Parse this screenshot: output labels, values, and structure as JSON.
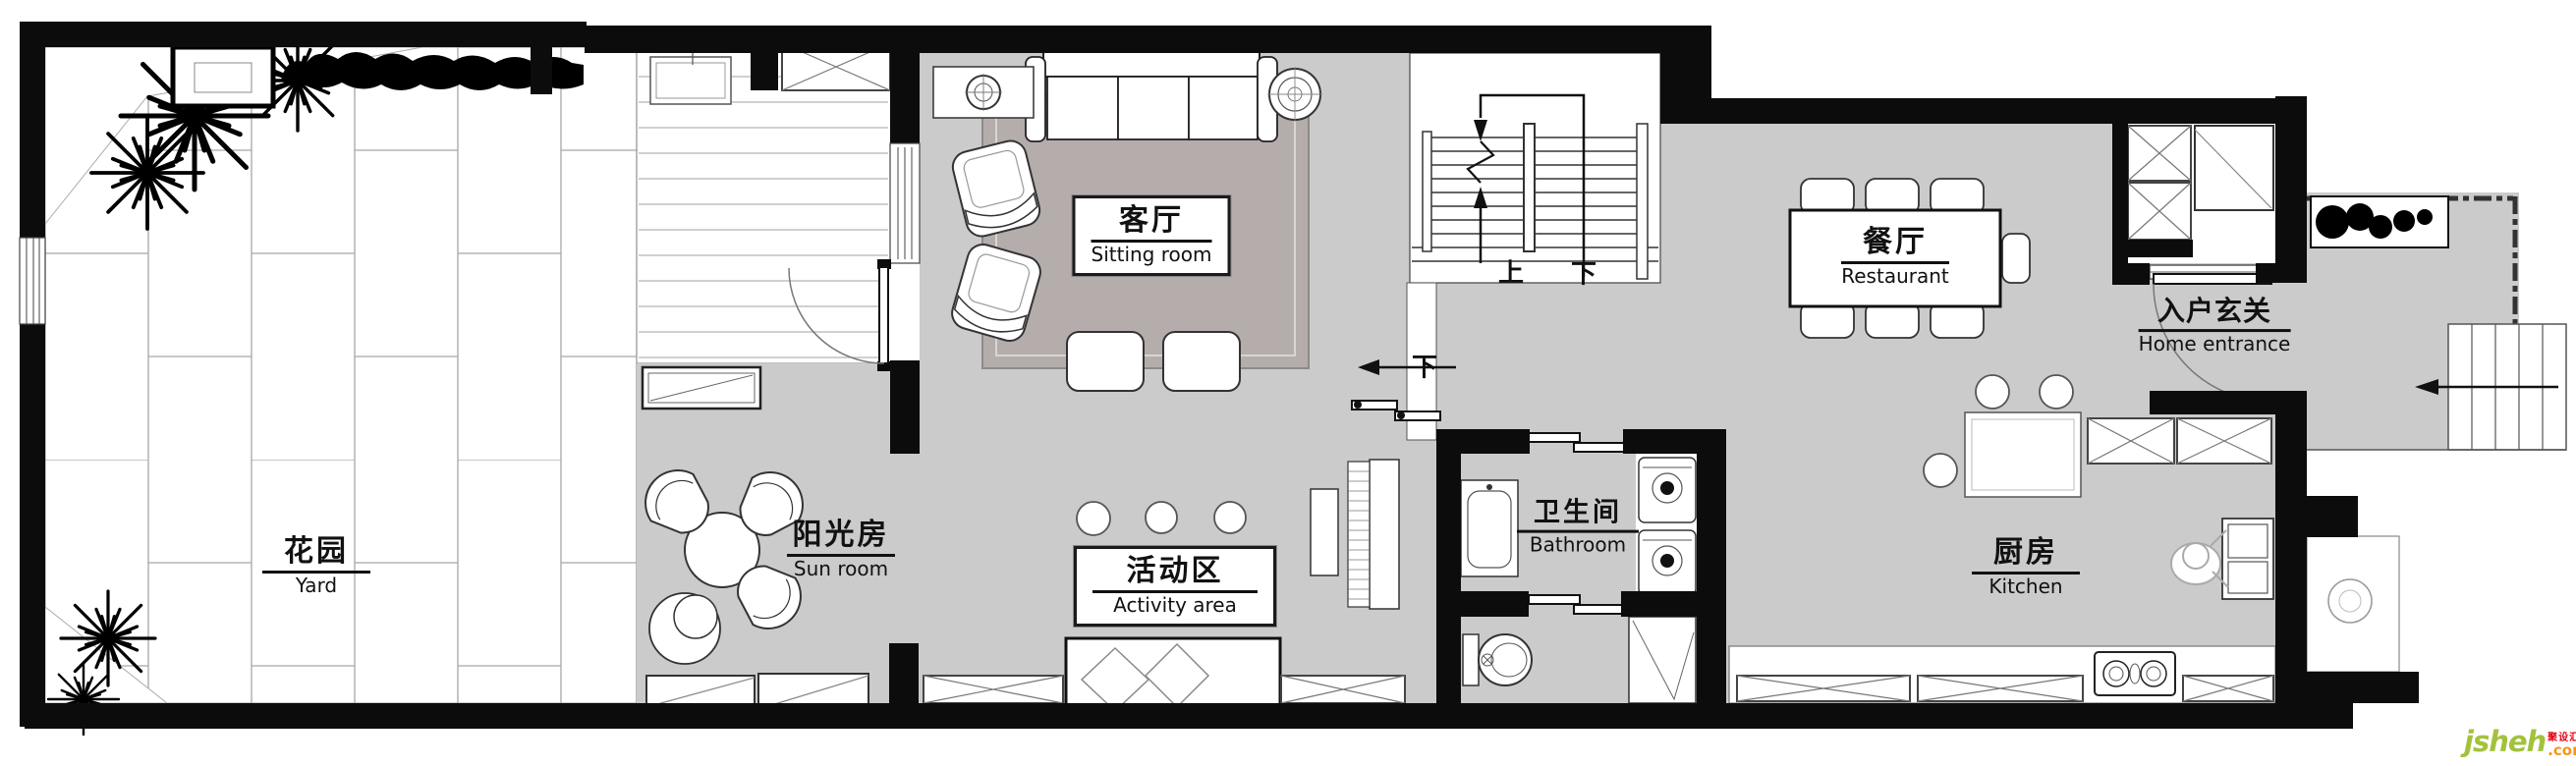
{
  "rooms": [
    {
      "id": "yard",
      "zh": "花园",
      "en": "Yard"
    },
    {
      "id": "sun_room",
      "zh": "阳光房",
      "en": "Sun room"
    },
    {
      "id": "sitting_room",
      "zh": "客厅",
      "en": "Sitting room"
    },
    {
      "id": "activity_area",
      "zh": "活动区",
      "en": "Activity area"
    },
    {
      "id": "bathroom",
      "zh": "卫生间",
      "en": "Bathroom"
    },
    {
      "id": "restaurant",
      "zh": "餐厅",
      "en": "Restaurant"
    },
    {
      "id": "kitchen",
      "zh": "厨房",
      "en": "Kitchen"
    },
    {
      "id": "home_entrance",
      "zh": "入户玄关",
      "en": "Home entrance"
    }
  ],
  "stairs": {
    "up": "上",
    "down": "下",
    "basement_down": "下"
  },
  "watermark": {
    "brand": "jsheh",
    "cn": "聚设汇",
    "suffix": ".com",
    "brand_color": "#a2c23c",
    "cn_color": "#e60012",
    "suffix_color": "#f7941d"
  },
  "colors": {
    "floor": "#cbcbcb",
    "rug": "#b4adab",
    "wall": "#0c0c0c"
  }
}
